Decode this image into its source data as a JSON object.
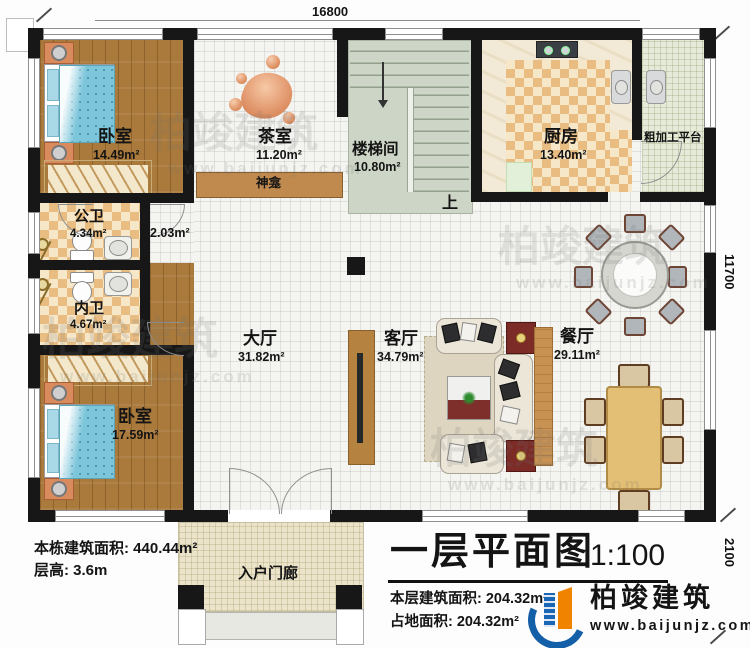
{
  "rooms": {
    "bedroom_top": {
      "name": "卧室",
      "area": "14.49m²"
    },
    "tea_room": {
      "name": "茶室",
      "area": "11.20m²"
    },
    "shrine": {
      "name": "神龛"
    },
    "stairwell": {
      "name": "楼梯间",
      "area": "10.80m²",
      "direction": "上"
    },
    "kitchen": {
      "name": "厨房",
      "area": "13.40m²"
    },
    "prep_platform": {
      "name": "粗加工平台"
    },
    "public_bathroom": {
      "name": "公卫",
      "area": "4.34m²"
    },
    "corridor": {
      "area": "2.03m²"
    },
    "private_bathroom": {
      "name": "内卫",
      "area": "4.67m²"
    },
    "bedroom_bottom": {
      "name": "卧室",
      "area": "17.59m²"
    },
    "great_hall": {
      "name": "大厅",
      "area": "31.82m²"
    },
    "living_room": {
      "name": "客厅",
      "area": "34.79m²"
    },
    "dining_room": {
      "name": "餐厅",
      "area": "29.11m²"
    },
    "entry_porch": {
      "name": "入户门廊"
    }
  },
  "dimensions": {
    "top_width": "16800",
    "right_height": "11700",
    "right_porch": "2100"
  },
  "building_stats": {
    "total_area": "本栋建筑面积: 440.44m²",
    "floor_height": "层高: 3.6m"
  },
  "title_block": {
    "title": "一层平面图",
    "scale": "1:100",
    "floor_area": "本层建筑面积: 204.32m²",
    "footprint_area": "占地面积: 204.32m²"
  },
  "brand": {
    "name": "柏竣建筑",
    "website": "www.baijunjz.com"
  }
}
